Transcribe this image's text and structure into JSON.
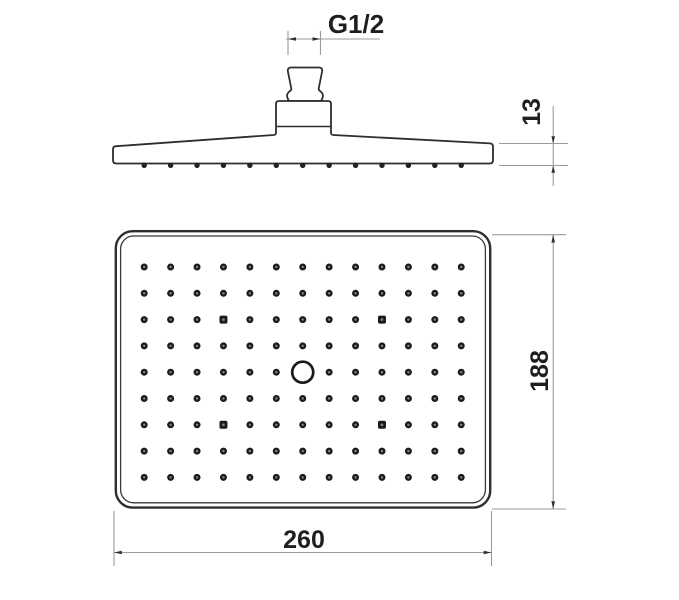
{
  "drawing": {
    "colors": {
      "background": "#ffffff",
      "outline": "#2e2e2e",
      "dim_line": "#9b9b9b",
      "arrow": "#2f2f2f",
      "text": "#1f1f1f",
      "dot": "#1c1c1c",
      "dot_highlight": "#868686"
    },
    "dimensions": {
      "thread": {
        "label": "G1/2"
      },
      "thickness": {
        "label": "13"
      },
      "height": {
        "label": "188"
      },
      "width": {
        "label": "260"
      }
    },
    "side_view": {
      "nozzle_bump_count": 13,
      "bump_y": 165.3,
      "bump_radius": 2.7
    },
    "face_view": {
      "grid": {
        "cols": 13,
        "rows": 9,
        "x0": 144.2,
        "y0": 267.0,
        "dx": 26.42,
        "dy": 26.3,
        "dot_radius": 3.5
      },
      "center_opening": {
        "col": 7,
        "row": 5,
        "radius": 10.5
      },
      "screws": [
        {
          "col": 4,
          "row": 3
        },
        {
          "col": 10,
          "row": 3
        },
        {
          "col": 4,
          "row": 7
        },
        {
          "col": 10,
          "row": 7
        }
      ]
    }
  }
}
